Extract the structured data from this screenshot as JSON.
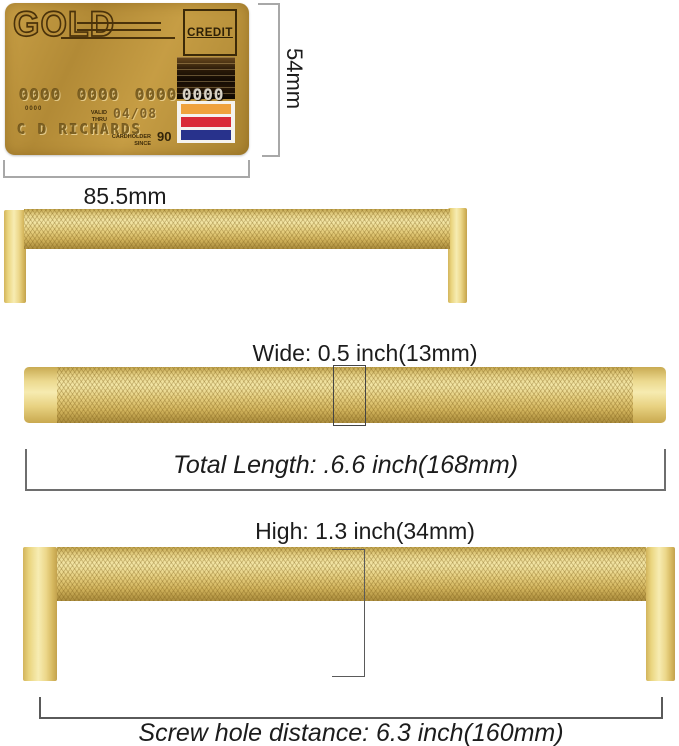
{
  "card": {
    "brand": "GOLD",
    "type_label": "CREDIT",
    "number_groups": [
      "0000",
      "0000",
      "0000",
      "0000"
    ],
    "small_number": "0000",
    "valid_label_1": "VALID",
    "valid_label_2": "THRU",
    "valid_value": "04/08",
    "holder_name": "C D RICHARDS",
    "since_label_1": "CARDHOLDER",
    "since_label_2": "SINCE",
    "since_value": "90",
    "stripe_colors": [
      "#EFA23D",
      "#D92A38",
      "#28328C"
    ],
    "card_gold": "#bd943e"
  },
  "annotations": {
    "card_height": "54mm",
    "card_width": "85.5mm",
    "wide_label": "Wide: 0.5 inch(13mm)",
    "total_length_label": "Total Length: .6.6 inch(168mm)",
    "high_label": "High: 1.3 inch(34mm)",
    "screw_hole_label": "Screw hole distance: 6.3 inch(160mm)"
  },
  "colors": {
    "handle_gold_light": "#f3e6a6",
    "handle_gold_dark": "#b79947",
    "annotation_line_light": "#a8a8a8",
    "annotation_line_dark": "#5a5a5a",
    "text": "#1c1c1c"
  }
}
